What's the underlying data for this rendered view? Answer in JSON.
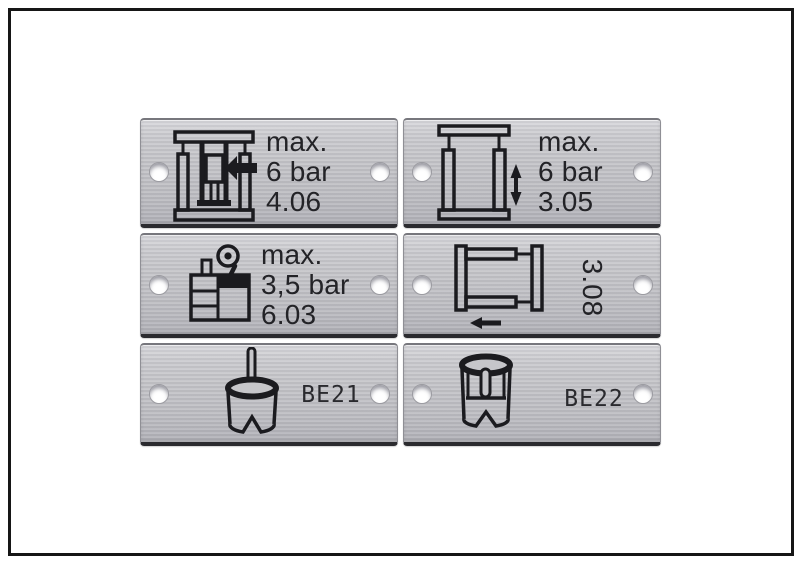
{
  "canvas": {
    "background": "#ffffff",
    "frame_color": "#161616",
    "plate_color": "#c4c4c8",
    "plate_edge_dark": "#2b2b2f",
    "text_color": "#232327"
  },
  "plates": [
    {
      "name": "plate-press",
      "icon": "press-icon",
      "lines": [
        "max.",
        "6 bar",
        "4.06"
      ]
    },
    {
      "name": "plate-frame-vertical",
      "icon": "frame-vertical-arrow-icon",
      "lines": [
        "max.",
        "6 bar",
        "3.05"
      ]
    },
    {
      "name": "plate-reservoir-gauge",
      "icon": "reservoir-gauge-icon",
      "lines": [
        "max.",
        "3,5 bar",
        "6.03"
      ]
    },
    {
      "name": "plate-frame-horizontal",
      "icon": "frame-horizontal-arrow-icon",
      "rotated_label": "3.08"
    },
    {
      "name": "plate-be21",
      "icon": "bell-tool-icon",
      "label": "BE21"
    },
    {
      "name": "plate-be22",
      "icon": "sleeve-tool-icon",
      "label": "BE22"
    }
  ]
}
